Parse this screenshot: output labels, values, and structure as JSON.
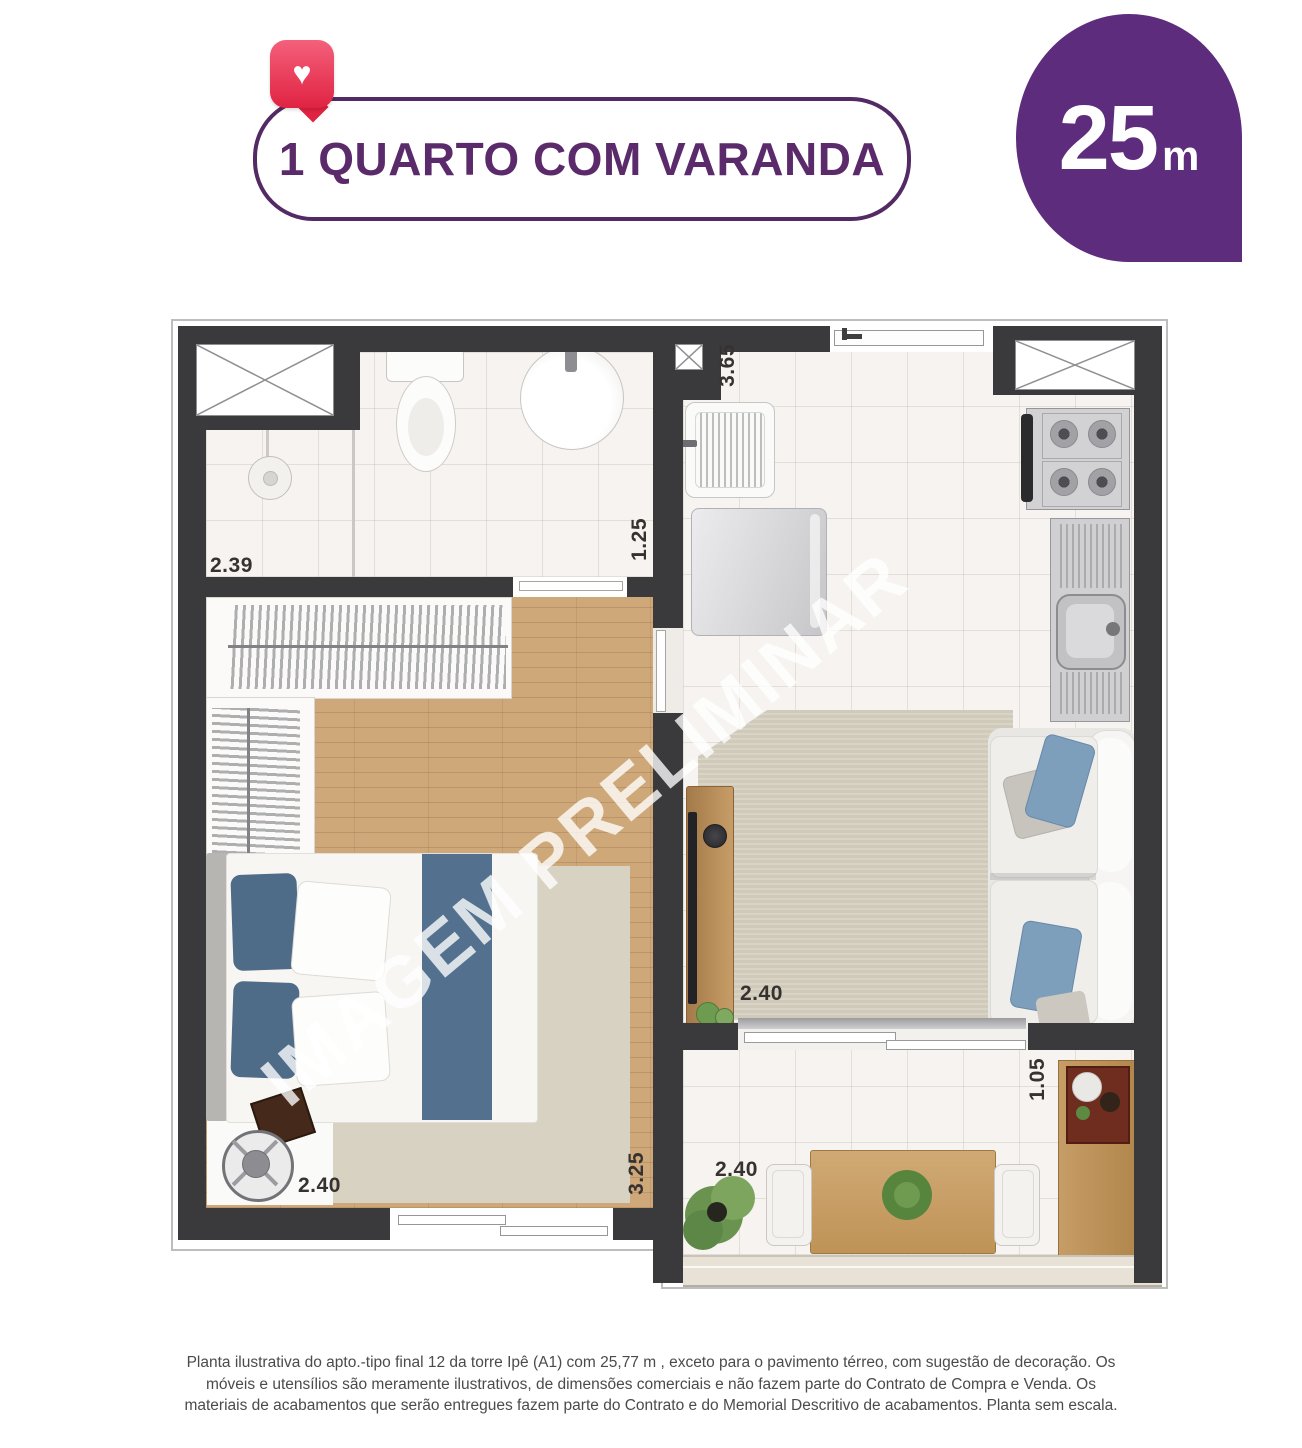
{
  "header": {
    "badge_label": "1 QUARTO COM VARANDA",
    "heart_icon": "heart",
    "area": {
      "value": "25",
      "unit": "m"
    }
  },
  "plan": {
    "watermark": "IMAGEM PRELIMINAR",
    "dimensions": {
      "shower_width": "2.39",
      "bathroom_depth": "1.25",
      "service_length": "3.65",
      "living_width": "2.40",
      "bedroom_width": "2.40",
      "bedroom_length": "3.25",
      "balcony_width": "2.40",
      "balcony_depth": "1.05"
    }
  },
  "footer": {
    "disclaimer": "Planta ilustrativa do apto.-tipo final 12 da torre Ipê (A1) com 25,77 m , exceto para o pavimento térreo, com sugestão de decoração. Os móveis e utensílios são meramente ilustrativos, de dimensões comerciais e não fazem parte do Contrato de Compra e Venda. Os materiais de acabamentos que serão entregues fazem parte do Contrato e do Memorial Descritivo de acabamentos. Planta sem escala."
  },
  "colors": {
    "purple": "#5e2c7d",
    "heart_red": "#e02342",
    "wall": "#3a3a3c",
    "wood": "#cfa87a"
  }
}
